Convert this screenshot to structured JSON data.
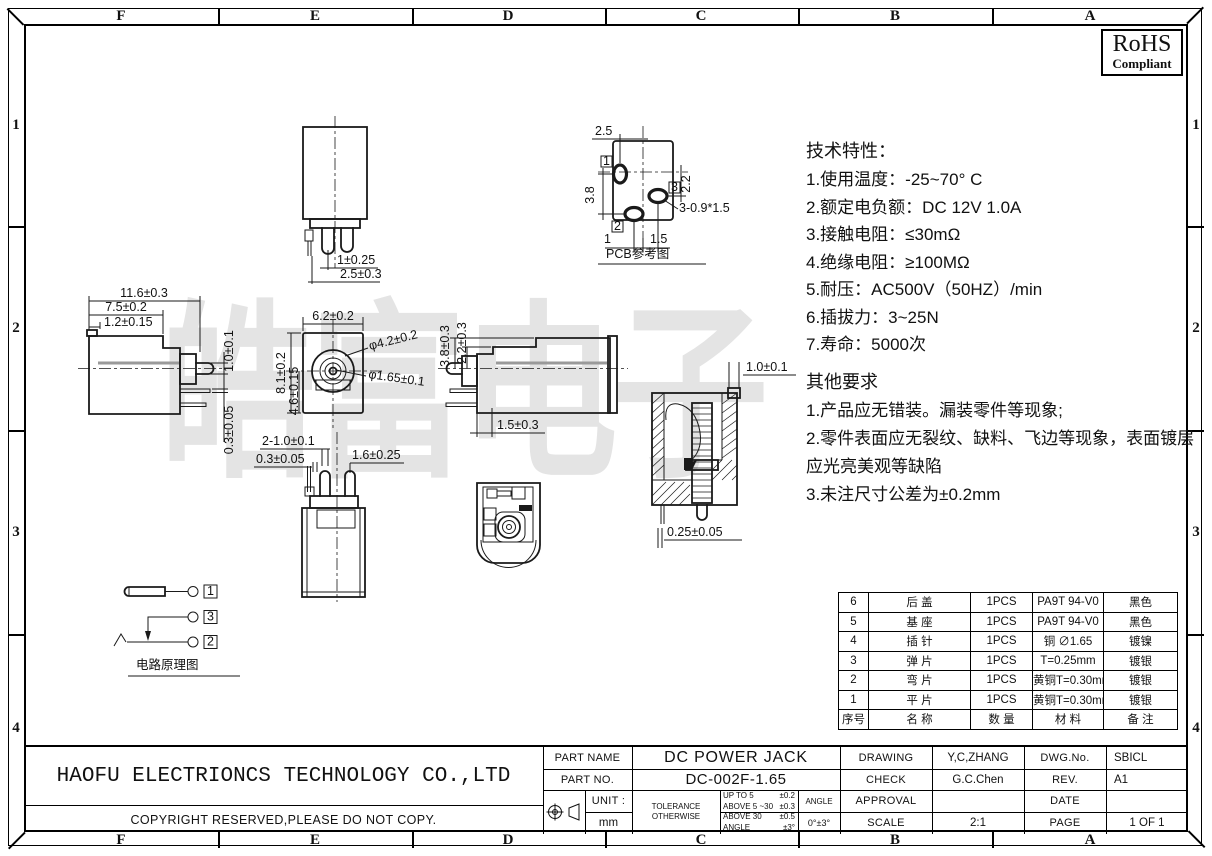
{
  "sheet": {
    "zones": {
      "cols": [
        "F",
        "E",
        "D",
        "C",
        "B",
        "A"
      ],
      "rows": [
        "1",
        "2",
        "3",
        "4"
      ]
    },
    "rohs_line1": "RoHS",
    "rohs_line2": "Compliant",
    "watermark": "皓富电子"
  },
  "notes": {
    "tech_title": "技术特性：",
    "tech": [
      "1.使用温度：-25~70° C",
      "2.额定电负额：DC 12V 1.0A",
      "3.接触电阻：≤30mΩ",
      "4.绝缘电阻：≥100MΩ",
      "5.耐压：AC500V（50HZ）/min",
      "6.插拔力：3~25N",
      "7.寿命：5000次"
    ],
    "other_title": "其他要求",
    "other": [
      "1.产品应无错装。漏装零件等现象;",
      "2.零件表面应无裂纹、缺料、飞边等现象，表面镀层应光亮美观等缺陷",
      "3.未注尺寸公差为±0.2mm"
    ]
  },
  "views": {
    "top": {
      "dim_pin_dia": "1±0.25",
      "dim_pin_pitch": "2.5±0.3"
    },
    "pcb": {
      "label": "PCB参考图",
      "dim_top": "2.5",
      "dim_left": "3.8",
      "dim_right": "2.2",
      "dim_bottom1": "1",
      "dim_bottom2": "1.5",
      "hole_note": "3-0.9*1.5",
      "m1": "1",
      "m2": "2",
      "m3": "3"
    },
    "side_left": {
      "dim_len": "11.6±0.3",
      "dim_body": "7.5±0.2",
      "dim_tab": "1.2±0.15",
      "dim_pin": "1.0±0.1",
      "dim_term": "0.3±0.05"
    },
    "front": {
      "dim_w": "6.2±0.2",
      "dim_h": "8.1±0.2",
      "dim_ch": "4.6±0.15",
      "dim_d1": "φ4.2±0.2",
      "dim_d2": "φ1.65±0.1"
    },
    "side_right": {
      "dim_h1": "3.8±0.3",
      "dim_h2": "2.2±0.3",
      "dim_off": "1.5±0.3"
    },
    "bottom": {
      "dim_pins": "2-1.0±0.1",
      "dim_term": "0.3±0.05",
      "dim_pin2": "1.6±0.25"
    },
    "section": {
      "dim_wall": "1.0±0.1",
      "dim_gap": "0.25±0.05"
    },
    "schematic": {
      "label": "电路原理图",
      "pin1": "1",
      "pin2": "2",
      "pin3": "3"
    }
  },
  "bom": {
    "headers": [
      "序号",
      "名 称",
      "数 量",
      "材 料",
      "备 注"
    ],
    "rows": [
      [
        "6",
        "后 盖",
        "1PCS",
        "PA9T 94-V0",
        "黑色"
      ],
      [
        "5",
        "基 座",
        "1PCS",
        "PA9T 94-V0",
        "黑色"
      ],
      [
        "4",
        "插 针",
        "1PCS",
        "铜 ∅1.65",
        "镀镍"
      ],
      [
        "3",
        "弹 片",
        "1PCS",
        "T=0.25mm",
        "镀银"
      ],
      [
        "2",
        "弯 片",
        "1PCS",
        "黄铜T=0.30mm",
        "镀银"
      ],
      [
        "1",
        "平 片",
        "1PCS",
        "黄铜T=0.30mm",
        "镀银"
      ]
    ]
  },
  "titleblock": {
    "company": "HAOFU ELECTRIONCS TECHNOLOGY CO.,LTD",
    "copyright": "COPYRIGHT RESERVED,PLEASE DO NOT COPY.",
    "part_name_label": "PART NAME",
    "part_name": "DC POWER JACK",
    "part_no_label": "PART NO.",
    "part_no": "DC-002F-1.65",
    "drawing_label": "DRAWING",
    "drawing_by": "Y,C,ZHANG",
    "check_label": "CHECK",
    "check_by": "G.C.Chen",
    "approval_label": "APPROVAL",
    "approval_by": "",
    "scale_label": "SCALE",
    "scale": "2:1",
    "dwg_no_label": "DWG.No.",
    "dwg_no": "SBICL",
    "rev_label": "REV.",
    "rev": "A1",
    "date_label": "DATE",
    "date": "",
    "page_label": "PAGE",
    "page": "1 OF 1",
    "unit_label": "UNIT :",
    "unit": "mm",
    "tol_label1": "TOLERANCE",
    "tol_label2": "OTHERWISE",
    "tol": [
      {
        "range": "UP TO 5",
        "val": "±0.2"
      },
      {
        "range": "ABOVE 5 ~30",
        "val": "±0.3"
      },
      {
        "range": "ABOVE 30",
        "val": "±0.5"
      },
      {
        "range": "ANGLE",
        "val": "±3°"
      }
    ],
    "angle_label": "ANGLE",
    "angle_tol": "0°±3°"
  }
}
